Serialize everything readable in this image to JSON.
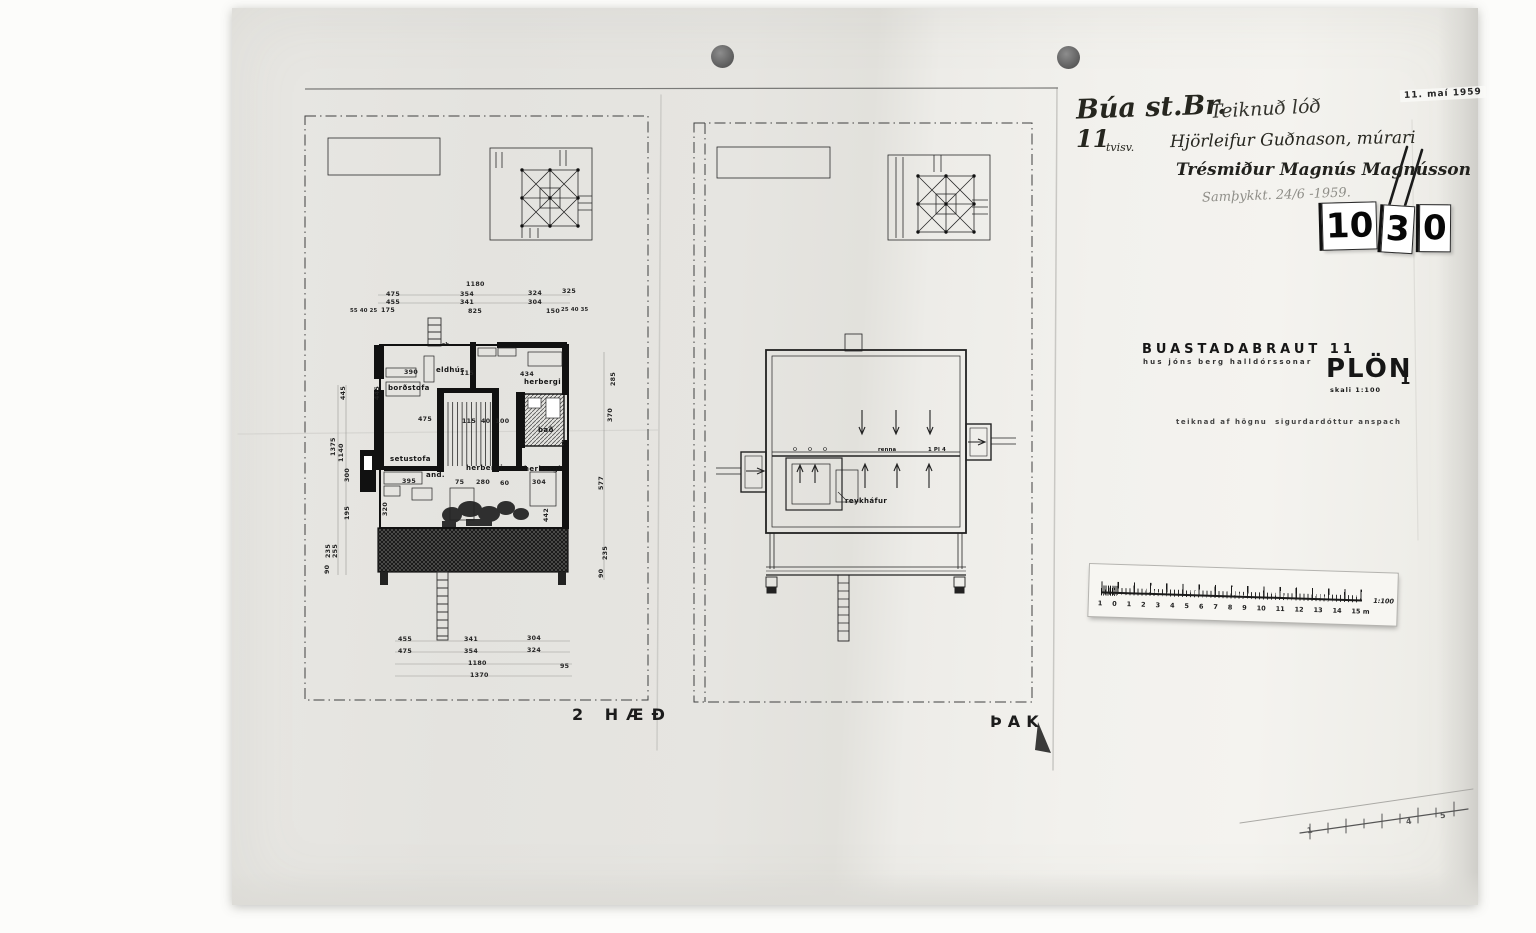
{
  "stamps": {
    "date": "11. maí 1959",
    "number_tiles": [
      "10",
      "3",
      "0"
    ]
  },
  "handwriting": {
    "line1_left": "Búa st.Br.",
    "line1_right": "Teiknuð lóð",
    "line2_number": "11",
    "line2_note": "tvisv.",
    "line2_name": "Hjörleifur Guðnason, múrari",
    "line3_name": "Trésmiður Magnús Magnússon",
    "line4_note": "Samþykkt. 24/6 -1959."
  },
  "title_block": {
    "street": "BUASTADABRAUT 11",
    "owner": "hus jóns berg halldórssonar",
    "sheet_title": "PLÖN",
    "scale_note": "skali 1:100",
    "sheet_no": "1",
    "credit": "teiknad af högnu  sigurdardóttur anspach"
  },
  "floor_plan": {
    "caption": "2 HÆÐ",
    "labels": [
      "eldhús",
      "borðstofa",
      "herbergi",
      "setustofa",
      "and.",
      "herbergi",
      "herbergi",
      "bað",
      "sk."
    ],
    "dims_top": [
      "1180",
      "475",
      "354",
      "324",
      "325",
      "455",
      "341",
      "304",
      "55 40 25",
      "175",
      "825",
      "150",
      "25 40 35"
    ],
    "dims_bottom": [
      "455",
      "341",
      "304",
      "475",
      "354",
      "324",
      "1180",
      "95",
      "1370"
    ],
    "dims_left": [
      "445",
      "1375",
      "1140",
      "300",
      "195",
      "255",
      "235",
      "90"
    ],
    "dims_right": [
      "285",
      "370",
      "577",
      "235",
      "90"
    ],
    "dims_inner": [
      "390",
      "115",
      "434",
      "445",
      "475",
      "115  40  100",
      "395",
      "75",
      "280",
      "60",
      "304",
      "320",
      "442"
    ]
  },
  "roof_plan": {
    "caption": "ÞAK",
    "chimney_label": "reykháfur",
    "gutter_label": "renna",
    "gutter_note": "1 Pl 4"
  },
  "scale_bar": {
    "labels": [
      "1",
      "0",
      "1",
      "2",
      "3",
      "4",
      "5",
      "6",
      "7",
      "8",
      "9",
      "10",
      "11",
      "12",
      "13",
      "14",
      "15 m"
    ],
    "ratio": "1:100"
  },
  "diag_ruler": {
    "labels": [
      "1",
      "4",
      "5"
    ]
  }
}
